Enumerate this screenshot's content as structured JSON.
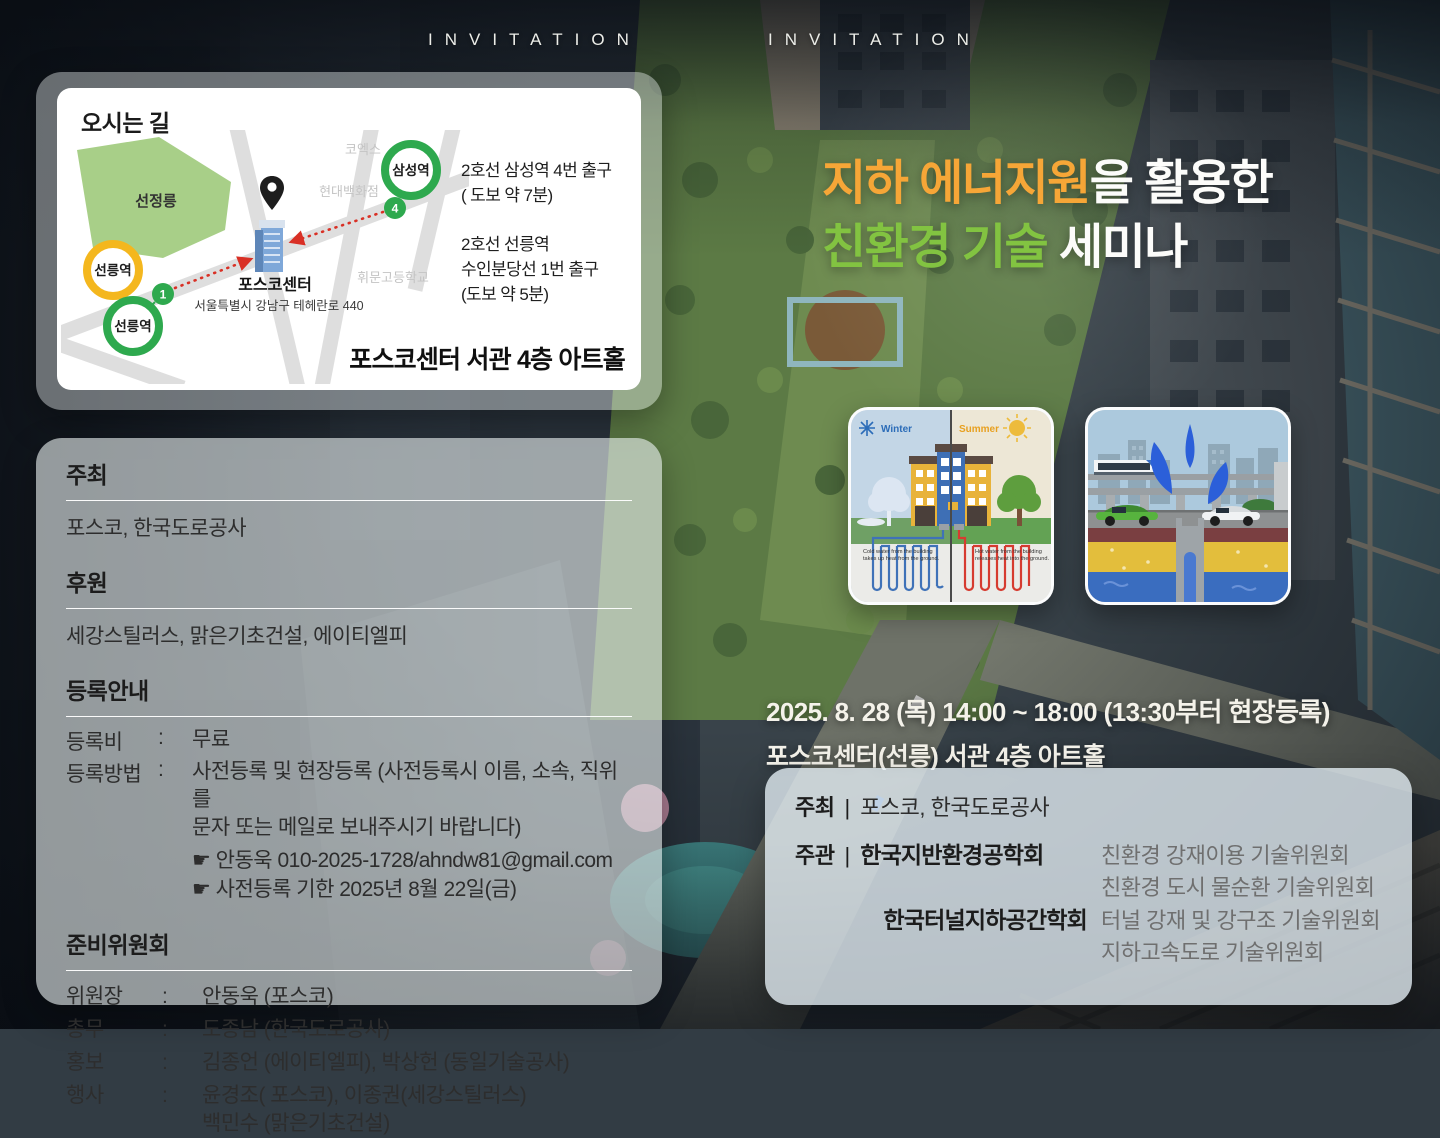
{
  "header": {
    "invitation_left": "INVITATION",
    "invitation_right": "INVITATION"
  },
  "colors": {
    "title_highlight_orange": "#F6A637",
    "title_highlight_green": "#82C341",
    "station_green": "#2EA94E",
    "station_yellow": "#F4B71E",
    "route_red": "#D93025"
  },
  "map_card": {
    "title": "오시는 길",
    "map": {
      "park_label": "선정릉",
      "coex_label": "코엑스",
      "hyundai_label": "현대백화점",
      "whimoon_label": "휘문고등학교",
      "building_label": "포스코센터",
      "address": "서울특별시 강남구 테헤란로 440",
      "station_samseong": "삼성역",
      "station_seolleung_yellow": "선릉역",
      "station_seolleung_green": "선릉역",
      "exit4": "4",
      "exit1": "1"
    },
    "directions": {
      "samseong": [
        "2호선 삼성역 4번 출구",
        "( 도보 약 7분)"
      ],
      "seolleung": [
        "2호선 선릉역",
        "수인분당선 1번 출구",
        "(도보 약 5분)"
      ]
    },
    "venue": "포스코센터 서관 4층 아트홀"
  },
  "title": {
    "line1_highlight": "지하 에너지원",
    "line1_rest": "을 활용한",
    "line2_highlight": "친환경 기술",
    "line2_rest": " 세미나"
  },
  "illustrations": {
    "geothermal": {
      "winter_label": "Winter",
      "summer_label": "Summer",
      "cold_caption_1": "Cold water from the building",
      "cold_caption_2": "takes up heat from the ground.",
      "hot_caption_1": "Hot water from the building",
      "hot_caption_2": "releases heat into the ground."
    }
  },
  "left_panel": {
    "host": {
      "heading": "주최",
      "value": "포스코, 한국도로공사"
    },
    "sponsor": {
      "heading": "후원",
      "value": "세강스틸러스, 맑은기초건설, 에이티엘피"
    },
    "registration": {
      "heading": "등록안내",
      "fee_label": "등록비",
      "fee_value": "무료",
      "method_label": "등록방법",
      "method_line1": "사전등록 및 현장등록 (사전등록시 이름, 소속, 직위를",
      "method_line2": "문자 또는 메일로 보내주시기 바랍니다)",
      "contact": "☛ 안동욱   010-2025-1728/ahndw81@gmail.com",
      "deadline": "☛ 사전등록 기한   2025년 8월 22일(금)"
    },
    "committee": {
      "heading": "준비위원회",
      "rows": [
        {
          "label": "위원장",
          "value": "안동욱 (포스코)"
        },
        {
          "label": "총무",
          "value": "도종남 (한국도로공사)"
        },
        {
          "label": "홍보",
          "value": "김종언 (에이티엘피), 박상헌 (동일기술공사)"
        },
        {
          "label": "행사",
          "value": "윤경조( 포스코), 이종권(세강스틸러스)",
          "value2": "백민수 (맑은기초건설)"
        }
      ]
    }
  },
  "event": {
    "datetime": "2025. 8. 28 (목)  14:00 ~ 18:00  (13:30부터 현장등록)",
    "venue": "포스코센터(선릉) 서관 4층 아트홀"
  },
  "org_panel": {
    "host_label": "주최",
    "host_value": "포스코, 한국도로공사",
    "organizer_label": "주관",
    "org1_name": "한국지반환경공학회",
    "org1_committee1": "친환경 강재이용 기술위원회",
    "org1_committee2": "친환경 도시 물순환 기술위원회",
    "org2_name": "한국터널지하공간학회",
    "org2_committee1": "터널 강재 및 강구조 기술위원회",
    "org2_committee2": "지하고속도로 기술위원회"
  },
  "punct": {
    "colon": ":",
    "pipe": "|"
  }
}
